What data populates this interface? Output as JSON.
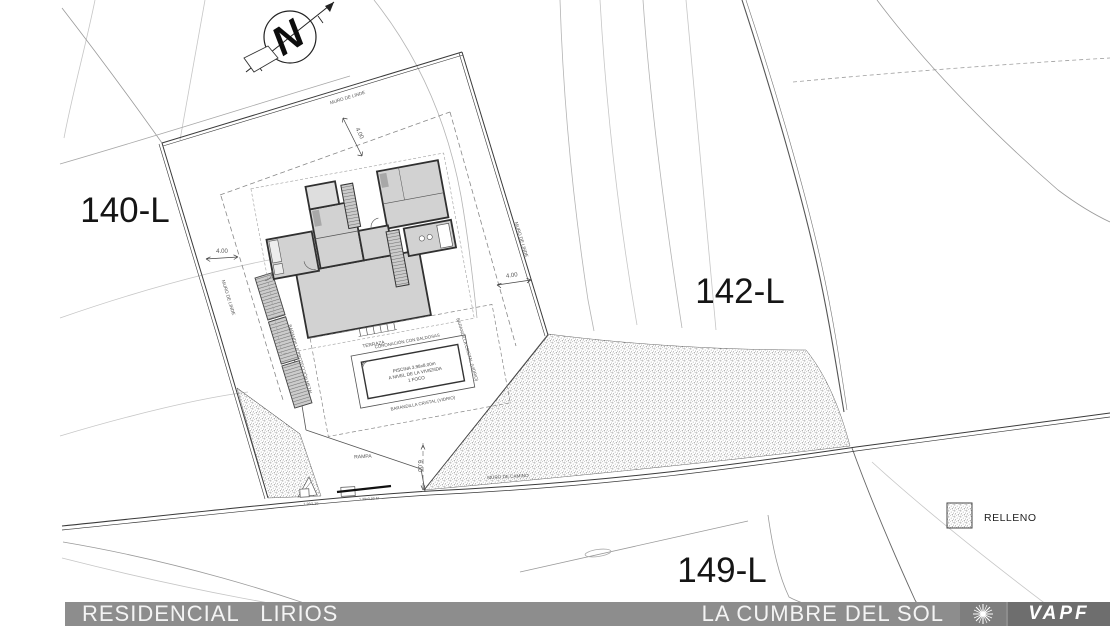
{
  "parcels": {
    "p140": "140-L",
    "p142": "142-L",
    "p149": "149-L"
  },
  "walls": {
    "linde_top": "MURO DE LINDE",
    "linde_left": "MURO DE LINDE",
    "linde_right": "MURO DE LINDE",
    "camino": "MURO DE CAMINO"
  },
  "dims": {
    "top": "4.00",
    "left": "4.00",
    "right": "4.00",
    "ramp": "6.00",
    "road_a": "1.26/1.39",
    "road_b": "1.39x3.90 M"
  },
  "site": {
    "terraza": "TERRAZA",
    "coronacion": "CORONACIÓN CON BALDOSAS",
    "piscina1": "PISCINA 3.98x8.00m",
    "piscina2": "A NIVEL DE LA VIVIENDA",
    "piscina3": "1 FOCO",
    "barandilla_cristal": "BARANDILLA CRISTAL (VIDRIO)",
    "barandilla_metal": "BARANDILLA PROTECCIÓN METAL",
    "rampa": "RAMPA"
  },
  "compass": {
    "north": "N"
  },
  "legend": {
    "relleno": "RELLENO"
  },
  "footer": {
    "residencial": "RESIDENCIAL   LIRIOS",
    "cumbre": "LA CUMBRE DEL SOL",
    "brand": "VAPF"
  },
  "colors": {
    "footer_bar": "#8d8d8d",
    "brand_box": "#6e6e6e",
    "sun_box": "#7e7e7e",
    "line_dark": "#3a3a3a",
    "contour": "#c6c6c6",
    "room_fill": "#d2d2d2"
  }
}
